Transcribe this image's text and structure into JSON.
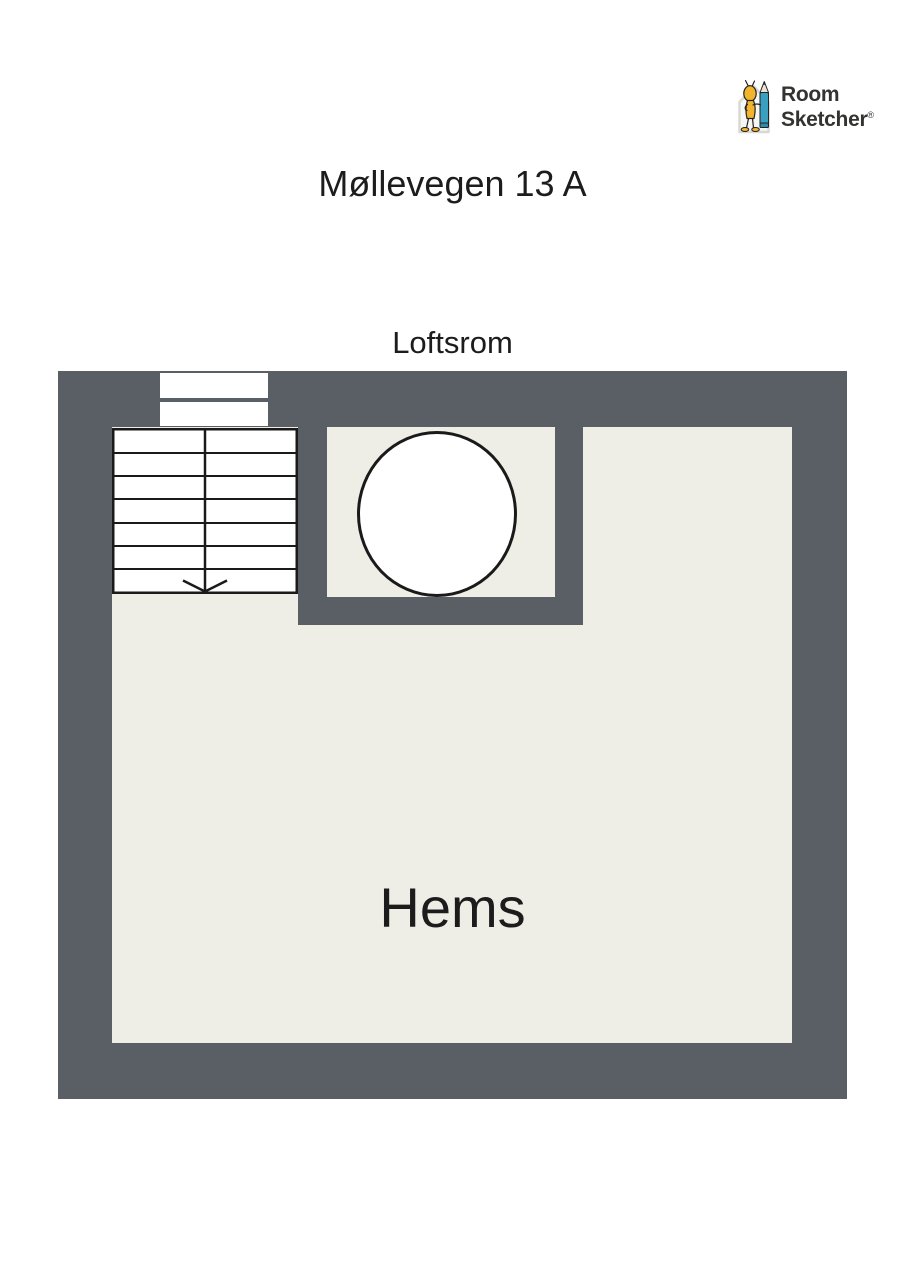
{
  "logo": {
    "brand_line1": "Room",
    "brand_line2": "Sketcher",
    "registered_mark": "®",
    "icon": "roomsketcher-mascot-with-pencil-icon"
  },
  "header": {
    "title": "Møllevegen 13 A"
  },
  "floor_plan": {
    "floor_label": "Loftsrom",
    "room_label": "Hems",
    "features": {
      "staircase": "staircase-with-down-arrow",
      "window": "wall-window",
      "opening": "circular-opening"
    }
  },
  "theme": {
    "page_background": "#ffffff",
    "wall_color": "#5a5f66",
    "floor_color": "#efeee6",
    "line_color": "#1a1a1a",
    "text_color": "#1c1c1c",
    "logo_text_color": "#333332",
    "mascot_yellow": "#f2b42d",
    "pencil_teal": "#3aa0c0",
    "house_gray": "#d8d8d4"
  }
}
